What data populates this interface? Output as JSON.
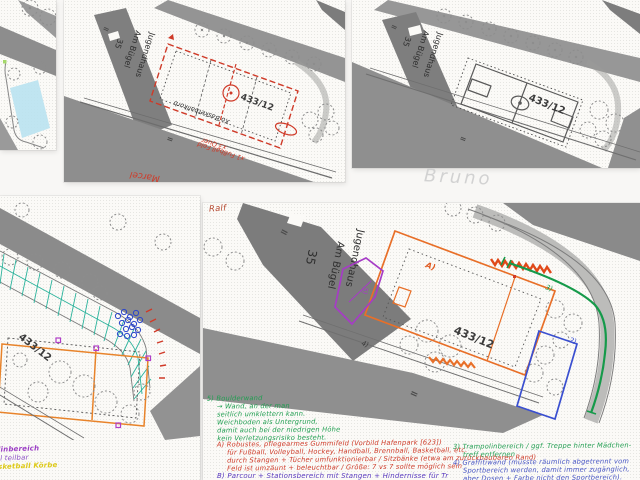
{
  "colors": {
    "red_annotation": "#cf3a28",
    "orange_annotation": "#e8702a",
    "green_annotation": "#1f9e50",
    "teal_grid": "#2cb39c",
    "blue_annotation": "#3a4fd0",
    "purple_annotation": "#a63cc6",
    "yellow_annotation": "#ddc918",
    "cyan_highlight": "#b9e2f0",
    "pencil_gray": "#d2d2d2",
    "plan_dark_gray": "#7d7d7d",
    "plan_mid_gray": "#939393"
  },
  "panels": {
    "top_middle": {
      "building": "Jugendhaus",
      "street": "Am Bügel",
      "house_number": "35",
      "parcel": "433/12",
      "map_symbol": "=",
      "annotations": {
        "basketball": "Xo Basketballkorb",
        "quer": "x3 Quer",
        "fussball": "x1 Fußball Feld",
        "author": "Marcel"
      }
    },
    "top_right": {
      "building": "Jugendhaus",
      "street": "Am Bügel",
      "house_number": "35",
      "parcel": "433/12",
      "map_symbol": "=",
      "author": "Bruno"
    },
    "bottom_left": {
      "parcel": "433/12",
      "annotations": {
        "line1": "linbereich",
        "line2": "ll teilbar",
        "line3": "sketball Körbe"
      }
    },
    "bottom_right": {
      "author": "Ralf",
      "building": "Jugendhaus",
      "street": "Am Bügel",
      "house_number": "35",
      "parcel": "433/12",
      "map_symbol": "=",
      "markers": {
        "a": "A)",
        "two": "2)",
        "three": "3)",
        "four": "4)",
        "five": "5)"
      },
      "note_boulderwand": {
        "lines": [
          "5) Boulderwand",
          "→ Wand, an der man",
          "seitlich umklettern kann.",
          "Weichboden als Untergrund,",
          "damit auch bei der niedrigen Höhe",
          "kein Verletzungsrisiko besteht."
        ]
      },
      "note_gummifeld": {
        "lines": [
          "A) Robustes, pflegearmes Gummifeld (Vorbild Hafenpark [623])",
          "für Fußball, Volleyball, Hockey, Handball, Brennball, Basketball, etc.",
          "durch Stangen + Tücher umfunktionierbar / Sitzbänke (etwa am zurückbaubaren Rand)",
          "Feld ist umzäunt + beleuchtbar / Größe: 7 vs 7 sollte möglich sein"
        ]
      },
      "note_trampolin": {
        "lines": [
          "3) Trampolinbereich / ggf. Treppe hinter Mädchen-",
          "treff entfernen"
        ]
      },
      "note_graffiti": {
        "lines": [
          "4) Graffitiwand (müsste räumlich abgetrennt vom",
          "Sportbereich werden, damit immer zugänglich,",
          "aber Dosen + Farbe nicht den Sportbereich)."
        ]
      },
      "note_parcour": "B) Parcour + Stationsbereich mit Stangen + Hindernisse für Tr"
    }
  }
}
